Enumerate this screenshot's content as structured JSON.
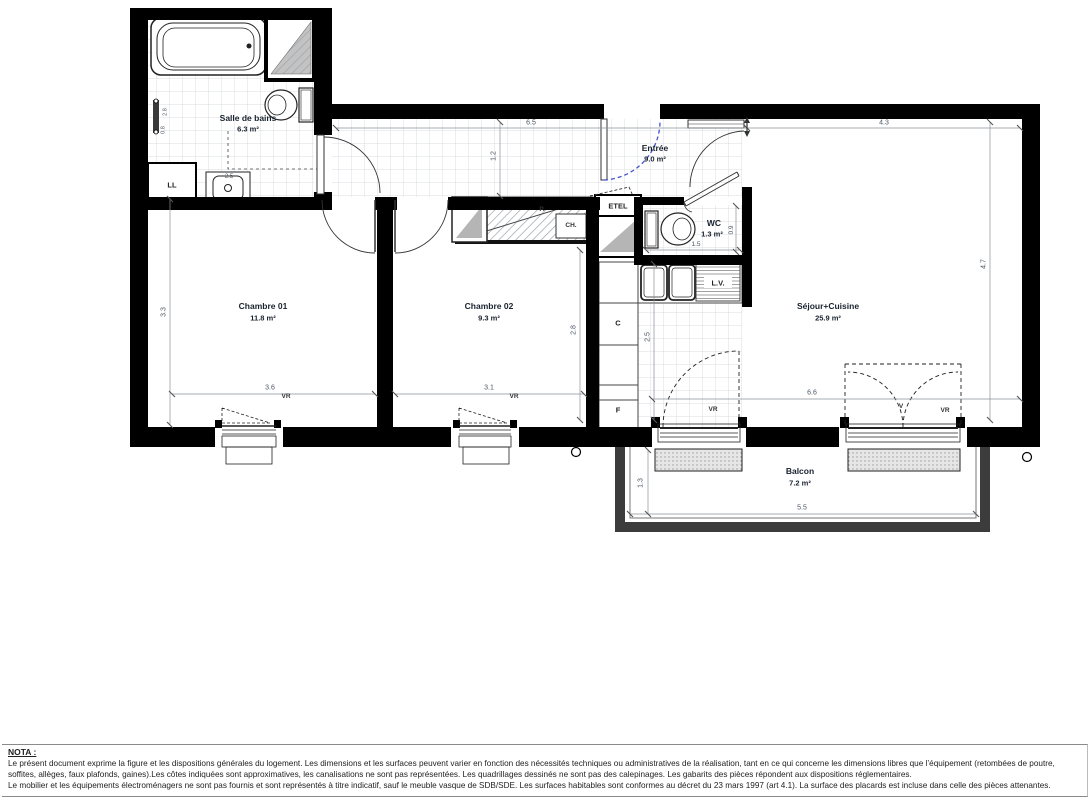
{
  "rooms": {
    "bathroom": {
      "name": "Salle de bains",
      "area": "6.3 m²"
    },
    "bedroom1": {
      "name": "Chambre 01",
      "area": "11.8 m²"
    },
    "bedroom2": {
      "name": "Chambre 02",
      "area": "9.3 m²"
    },
    "entry": {
      "name": "Entrée",
      "area": "9.0 m²"
    },
    "wc": {
      "name": "WC",
      "area": "1.3 m²"
    },
    "living": {
      "name": "Séjour+Cuisine",
      "area": "25.9 m²"
    },
    "balcony": {
      "name": "Balcon",
      "area": "7.2 m²"
    }
  },
  "fixtures": {
    "washing_machine": "LL",
    "electrical_panel": "ETEL",
    "closet": "P.",
    "water_heater": "CH.",
    "dishwasher": "L.V.",
    "cooker": "C",
    "fridge": "F",
    "roller_shutter": "VR",
    "vent": "V"
  },
  "dimensions": {
    "entry_top_width": "6.5",
    "living_top_width": "4.3",
    "hall_depth": "1.2",
    "bathroom_left_a": "2.8",
    "bathroom_left_b": "0.8",
    "bedroom1_height": "3.3",
    "bedroom1_width": "3.6",
    "bedroom2_width": "3.1",
    "bedroom2_height": "2.8",
    "kitchen_depth": "2.5",
    "bathroom_basin": "2.5",
    "wc_width": "1.5",
    "wc_depth": "0.9",
    "living_height": "4.7",
    "living_width": "6.6",
    "balcony_width": "5.5",
    "balcony_depth": "1.3"
  },
  "nota": {
    "heading": "NOTA :",
    "line1": "Le présent document exprime la figure et les dispositions générales du logement. Les dimensions et les surfaces peuvent varier en fonction des nécessités techniques ou administratives de la réalisation, tant en ce qui concerne les dimensions libres que l’équipement (retombées de poutre,",
    "line2": "soffites, allèges, faux plafonds, gaines).Les côtes indiquées sont approximatives, les canalisations ne sont pas représentées. Les quadrillages dessinés ne sont pas des calepinages. Les gabarits des pièces répondent aux dispositions réglementaires.",
    "line3": "Le mobilier et les équipements électroménagers ne sont pas fournis et sont représentés à titre indicatif, sauf le meuble vasque de SDB/SDE. Les surfaces habitables sont conformes au décret du 23 mars 1997 (art 4.1). La surface des placards est incluse dans celle des pièces attenantes."
  }
}
